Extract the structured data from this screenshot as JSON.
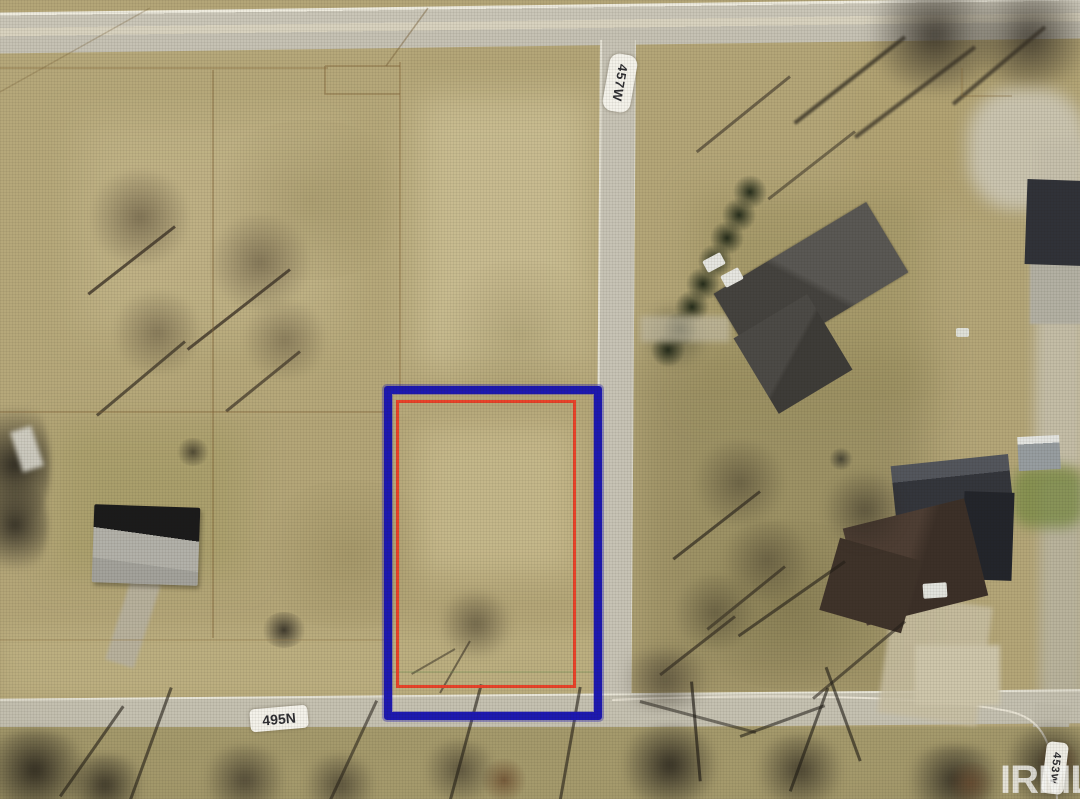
{
  "map": {
    "type": "aerial-parcel-view",
    "watermark": "IRMLS",
    "road_labels": [
      {
        "id": "road-457w",
        "label": "457W",
        "orientation": "vertical"
      },
      {
        "id": "road-495n",
        "label": "495N",
        "orientation": "horizontal"
      },
      {
        "id": "road-453w",
        "label": "453W",
        "orientation": "vertical"
      }
    ],
    "parcel": {
      "outer_outline_color": "#1d18b0",
      "inner_outline_color": "#e8432a"
    },
    "colors": {
      "field_tan": "#b4a678",
      "field_olive": "#988c5a",
      "road_gray": "#c7c3b5",
      "road_edge_line": "#eeebde",
      "tree_shadow": "#4b4234",
      "evergreen": "#232b1a"
    }
  }
}
